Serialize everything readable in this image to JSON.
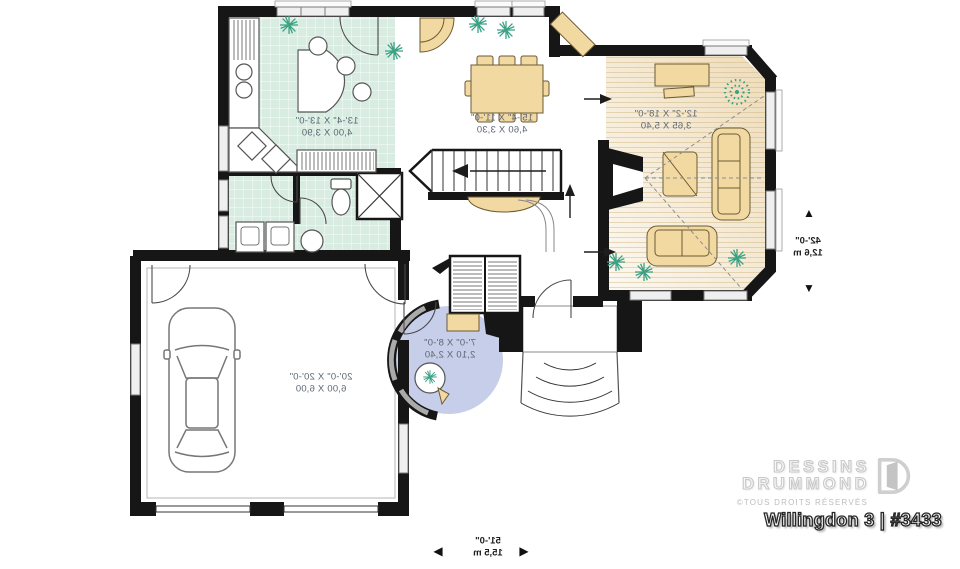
{
  "plan_labels": {
    "kitchen": {
      "imperial": "13'-4\" X 13'-0\"",
      "metric": "4,00 X 3,90"
    },
    "dining": {
      "imperial": "15'-4\" X 11'-0\"",
      "metric": "4,60 X 3,30"
    },
    "living": {
      "imperial": "12'-2\" X 18'-0\"",
      "metric": "3,65 X 5,40"
    },
    "foyer": {
      "imperial": "7'-0\" X 8'-0\"",
      "metric": "2,10 X 2,40"
    },
    "garage": {
      "imperial": "20'-0\" X 20'-0\"",
      "metric": "6,00 X 6,00"
    }
  },
  "overall_dimensions": {
    "width": {
      "imperial": "51'-0\"",
      "metric": "15,5 m"
    },
    "depth": {
      "imperial": "42'-0\"",
      "metric": "12,6 m"
    }
  },
  "icons": {
    "dim_arrow_left": "◀",
    "dim_arrow_right": "▶",
    "dim_arrow_up": "▲",
    "dim_arrow_down": "▼"
  },
  "branding": {
    "name_line1": "DESSINS",
    "name_line2": "DRUMMOND",
    "rights": "©TOUS DROITS RÉSERVÉS",
    "plan_title": "Willingdon 3 | #3433"
  },
  "colors": {
    "wall": "#161616",
    "tile": "#d9ece2",
    "wood": "#eedcba",
    "foyer": "#c7cee9",
    "furniture": "#f2d9a2",
    "plant": "#3aa183",
    "label": "#5c6673",
    "brand": "#c9c9c9"
  }
}
